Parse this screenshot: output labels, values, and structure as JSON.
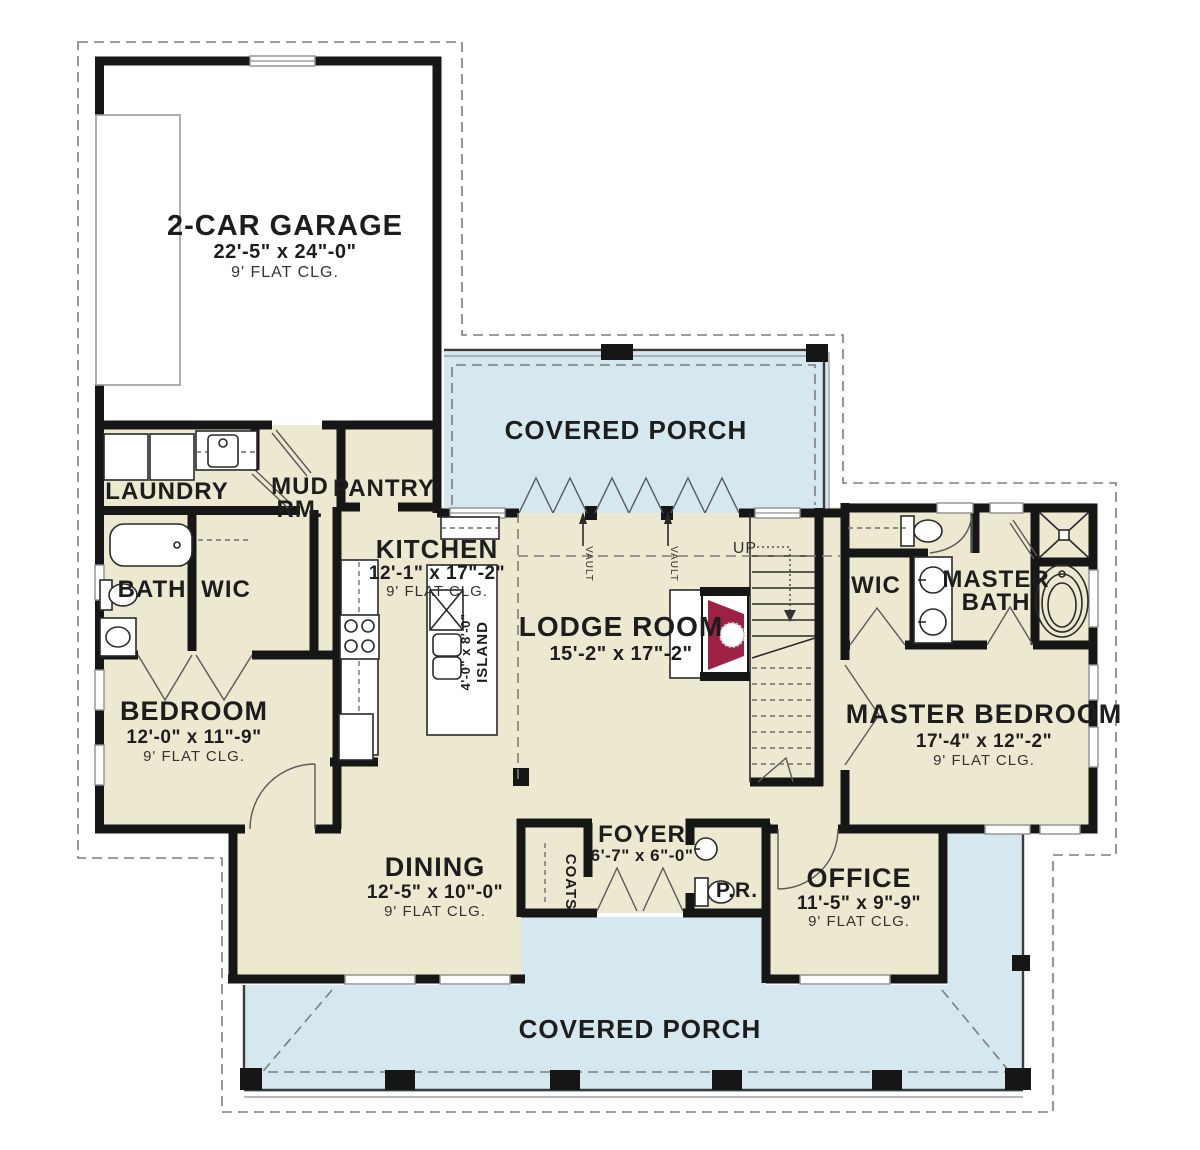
{
  "plan": {
    "garage": {
      "name": "2-CAR GARAGE",
      "dims": "22'-5\" x 24\"-0\"",
      "clg": "9' FLAT CLG."
    },
    "porch_top": {
      "name": "COVERED PORCH"
    },
    "porch_bottom": {
      "name": "COVERED PORCH"
    },
    "laundry": {
      "name": "LAUNDRY"
    },
    "mud": {
      "line1": "MUD",
      "line2": "RM."
    },
    "pantry": {
      "name": "PANTRY"
    },
    "kitchen": {
      "name": "KITCHEN",
      "dims": "12'-1\" x 17\"-2\"",
      "clg": "9' FLAT CLG."
    },
    "island": {
      "dims": "4'-0\" x 8'-0\"",
      "name": "ISLAND"
    },
    "lodge": {
      "name": "LODGE ROOM",
      "dims": "15'-2\" x 17\"-2\""
    },
    "stairs": {
      "up": "UP"
    },
    "vault": {
      "label": "VAULT"
    },
    "bath": {
      "name": "BATH"
    },
    "wic_left": {
      "name": "WIC"
    },
    "wic_right": {
      "name": "WIC"
    },
    "master_bath": {
      "line1": "MASTER",
      "line2": "BATH"
    },
    "bedroom": {
      "name": "BEDROOM",
      "dims": "12'-0\" x 11\"-9\"",
      "clg": "9' FLAT CLG."
    },
    "master_bedroom": {
      "name": "MASTER BEDROOM",
      "dims": "17'-4\" x 12\"-2\"",
      "clg": "9' FLAT CLG."
    },
    "dining": {
      "name": "DINING",
      "dims": "12'-5\" x 10\"-0\"",
      "clg": "9' FLAT CLG."
    },
    "foyer": {
      "name": "FOYER",
      "dims": "6'-7\" x 6\"-0\""
    },
    "coats": {
      "name": "COATS"
    },
    "powder": {
      "name": "P.R."
    },
    "office": {
      "name": "OFFICE",
      "dims": "11'-5\" x 9\"-9\"",
      "clg": "9' FLAT CLG."
    }
  },
  "colors": {
    "floor": "#EDE9D0",
    "porch": "#D5E8F0",
    "wall": "#161616",
    "fireplace": "#9E2144",
    "line": "#8A8A8A"
  }
}
